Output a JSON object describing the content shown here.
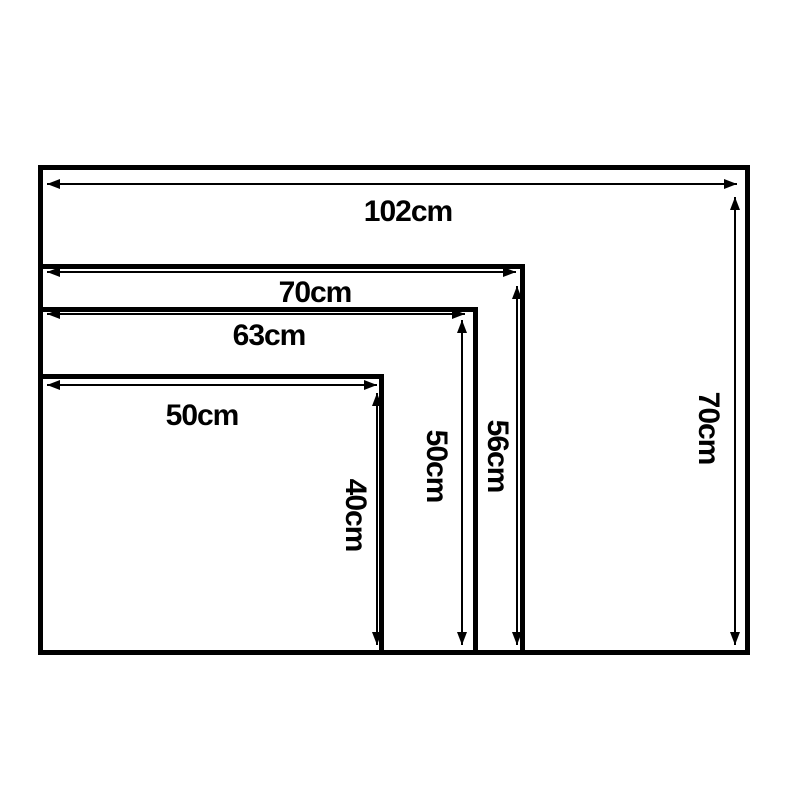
{
  "diagram": {
    "description": "Nested rectangle size comparison",
    "unit": "cm",
    "background_color": "#ffffff",
    "line_color": "#000000",
    "sizes": [
      {
        "id": "102x70",
        "width_cm": 102,
        "height_cm": 70,
        "width_label": "102cm",
        "height_label": "70cm"
      },
      {
        "id": "70x56",
        "width_cm": 70,
        "height_cm": 56,
        "width_label": "70cm",
        "height_label": "56cm"
      },
      {
        "id": "63x50",
        "width_cm": 63,
        "height_cm": 50,
        "width_label": "63cm",
        "height_label": "50cm"
      },
      {
        "id": "50x40",
        "width_cm": 50,
        "height_cm": 40,
        "width_label": "50cm",
        "height_label": "40cm"
      }
    ]
  }
}
